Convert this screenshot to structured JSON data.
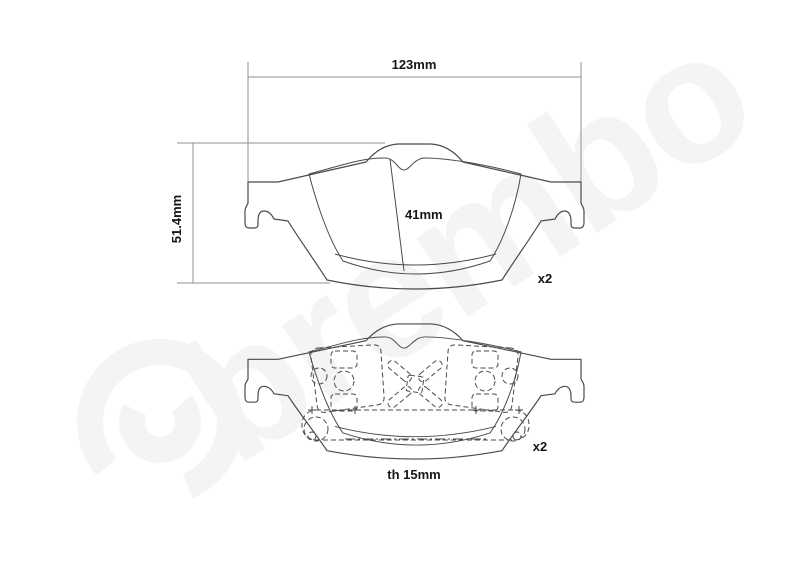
{
  "drawing": {
    "kind": "brake-pad technical drawing",
    "top_view": {
      "width_label": "123mm",
      "height_label": "51.4mm",
      "pad_height_label": "41mm",
      "quantity_label": "x2"
    },
    "bottom_view": {
      "quantity_label": "x2",
      "thickness_label": "th 15mm"
    }
  },
  "watermark": {
    "text": "brembo"
  },
  "colors": {
    "background": "#ffffff",
    "outline": "#4a4a4a",
    "dimension_lines": "#8f8f8f",
    "label_text": "#161616",
    "watermark": "#f4f4f4"
  }
}
